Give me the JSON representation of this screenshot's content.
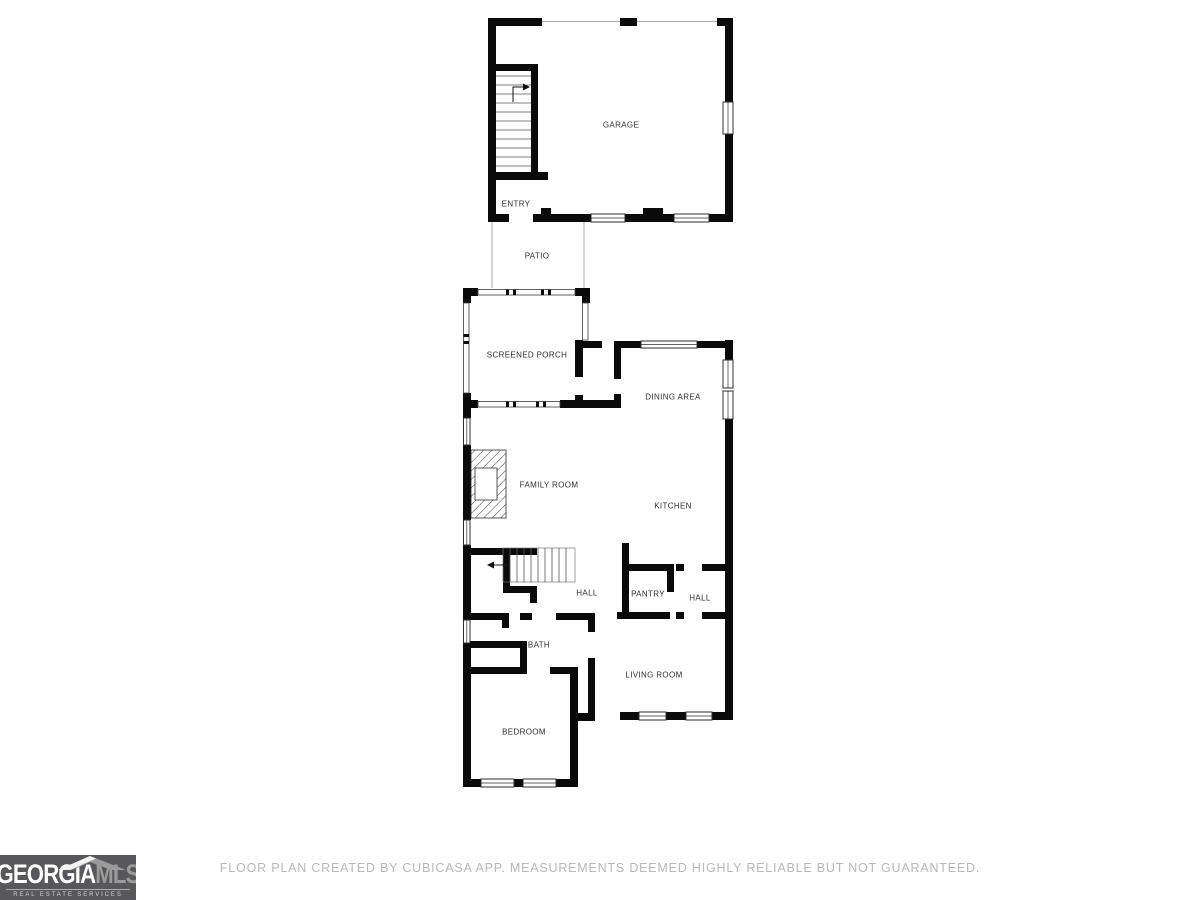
{
  "floorplan": {
    "wall_color": "#0a0a0a",
    "thin_line_color": "#a8a8a8",
    "label_color": "#2e2e2e",
    "rooms": [
      {
        "label": "GARAGE"
      },
      {
        "label": "ENTRY"
      },
      {
        "label": "PATIO"
      },
      {
        "label": "SCREENED PORCH"
      },
      {
        "label": "DINING AREA"
      },
      {
        "label": "FAMILY ROOM"
      },
      {
        "label": "KITCHEN"
      },
      {
        "label": "HALL"
      },
      {
        "label": "PANTRY"
      },
      {
        "label": "HALL"
      },
      {
        "label": "BATH"
      },
      {
        "label": "LIVING ROOM"
      },
      {
        "label": "BEDROOM"
      }
    ]
  },
  "footer": {
    "disclaimer": "FLOOR PLAN CREATED BY CUBICASA APP. MEASUREMENTS DEEMED HIGHLY RELIABLE BUT NOT GUARANTEED.",
    "text_color": "#b8b8b8"
  },
  "logo": {
    "brand_primary": "GEORGIA",
    "brand_secondary": "MLS",
    "tagline": "REAL ESTATE SERVICES",
    "background_color": "#58585a",
    "primary_color": "#ffffff",
    "secondary_color": "#9b9b9b"
  }
}
